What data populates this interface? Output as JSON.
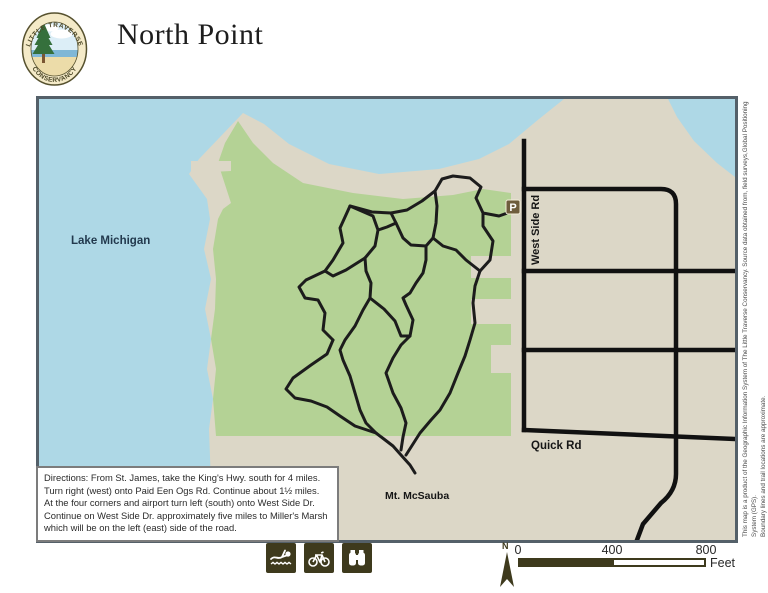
{
  "header": {
    "title": "North Point",
    "logo": {
      "top_text": "LITTLE TRAVERSE",
      "bottom_text": "CONSERVANCY"
    }
  },
  "map": {
    "labels": {
      "lake": "Lake Michigan",
      "west_side_rd": "West Side Rd",
      "quick_rd": "Quick Rd",
      "mt_mcsauba": "Mt. McSauba",
      "parking": "P"
    },
    "directions": "Directions: From St. James, take the King's Hwy. south for 4 miles.\nTurn right (west) onto Paid Een Ogs Rd. Continue about 1½ miles.\nAt the four corners and airport turn left (south) onto West Side Dr.\nContinue on West Side Dr. approximately five miles to Miller's Marsh\n which will be on the left (east) side of the road.",
    "colors": {
      "water": "#aed8e6",
      "land": "#dcd7c7",
      "conservancy_green": "#b4d295",
      "road": "#111111",
      "trail": "#1c1c1c",
      "frame": "#546069",
      "parking_brown": "#6e5c3c",
      "icon_olive": "#3e3a1d"
    }
  },
  "footer": {
    "icons": [
      "swimming-icon",
      "bicycle-icon",
      "binoculars-icon"
    ],
    "north_label": "N",
    "scale": {
      "ticks": [
        "0",
        "400",
        "800"
      ],
      "unit": "Feet"
    }
  },
  "side_note": {
    "line1": "This map is a product of the Geographic Information System of The Little Traverse Conservancy. Source data obtained from, field surveys,Global Positioning System (GPS).",
    "line2": "Boundary lines and trail locations are approximate."
  }
}
